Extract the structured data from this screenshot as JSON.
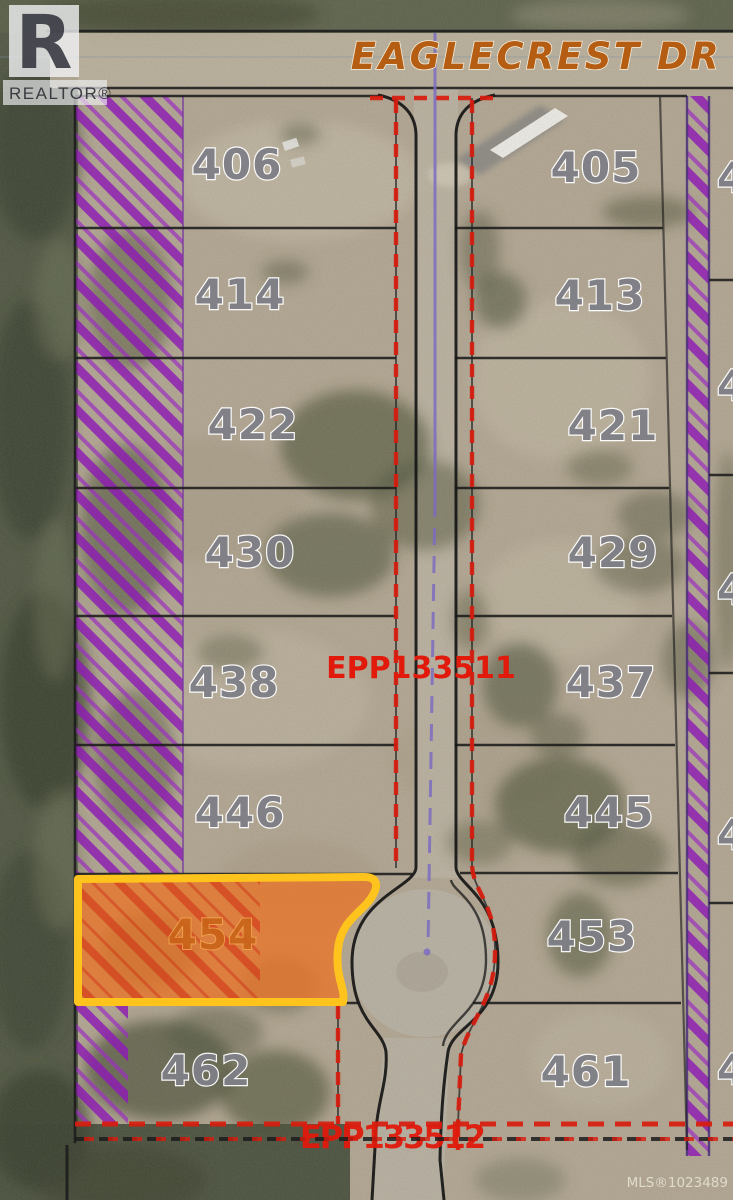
{
  "branding": {
    "realtor_logo_letter": "R",
    "realtor_wordmark": "REALTOR®",
    "mls_label": "MLS®1023489"
  },
  "street": {
    "name": "EAGLECREST DR"
  },
  "plans": {
    "road_plan": "EPP133511",
    "boundary_plan": "EPP133512"
  },
  "lots": {
    "left": [
      "406",
      "414",
      "422",
      "430",
      "438",
      "446",
      "462"
    ],
    "right": [
      "405",
      "413",
      "421",
      "429",
      "437",
      "445",
      "453",
      "461"
    ],
    "highlighted": "454",
    "edge_partial": "4"
  },
  "colors": {
    "highlight_fill": "#e9762a",
    "highlight_border": "#ffc31e",
    "hatch_purple": "#8d1bb3",
    "plan_red": "#d81a0c",
    "street_orange": "#b45d13",
    "lot_number_gray": "#7f7f87"
  }
}
